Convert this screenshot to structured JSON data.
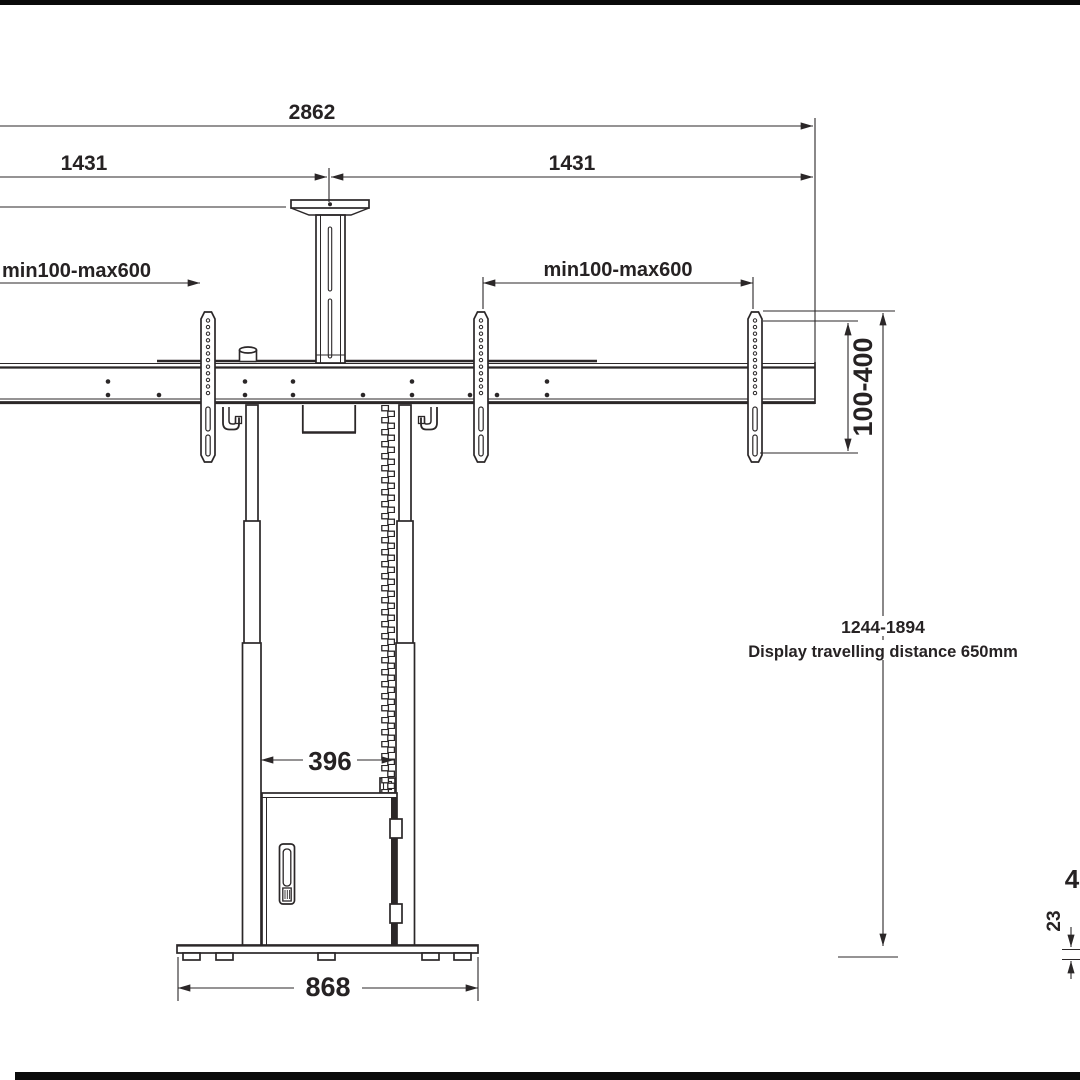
{
  "drawing": {
    "type": "technical-dimension-drawing",
    "subject": "dual-display motorized floor lift stand, front view",
    "dims": {
      "total_width": "2862",
      "half_width_left": "1431",
      "half_width_right": "1431",
      "vesa_range_left": "min100-max600",
      "vesa_range_right": "min100-max600",
      "bracket_height_range": "100-400",
      "height_range": "1244-1894",
      "travel_note": "Display travelling distance 650mm",
      "inner_clear_width": "396",
      "base_width": "868",
      "base_foot_height": "23",
      "partial_dim_right_edge": "4"
    },
    "colors": {
      "line": "#2b2728",
      "text": "#262223",
      "background": "#ffffff",
      "crop_strip": "#0a0a0a"
    }
  }
}
